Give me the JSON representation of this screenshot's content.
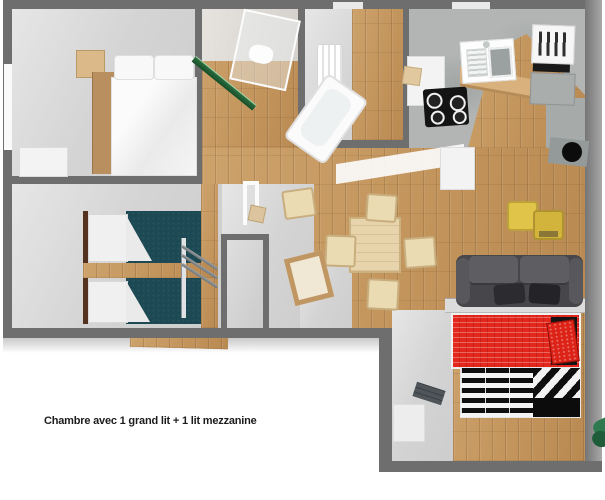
{
  "canvas": {
    "width": 605,
    "height": 500,
    "background": "#ffffff"
  },
  "caption": {
    "text": "Chambre avec 1 grand lit + 1 lit mezzanine"
  },
  "palette": {
    "wall": "#6e6e6e",
    "floor_wood": "#c69c64",
    "floor_gray": "#d4d4d4",
    "floor_concrete": "#b2b5b4",
    "bed_teal": "#1c4953",
    "bed_red": "#e3271d",
    "sofa_gray": "#47474b",
    "pouf_yellow": "#dfc449",
    "pouf_yellow2": "#d2b33c",
    "chair_beige": "#ebdbb2",
    "table_wood": "#e8d4ac",
    "ski_green": "#2c6e3f",
    "logo_green": "#2e7a4e",
    "logo_green2": "#1f5c39",
    "caption": "#1c1c1c"
  },
  "floorplan": {
    "type": "3d-floorplan-render",
    "rooms": [
      {
        "name": "bedroom-double",
        "furniture": [
          "double-bed-white",
          "nightstand",
          "dresser",
          "window"
        ]
      },
      {
        "name": "shower-room",
        "furniture": [
          "shower-cabin",
          "skis"
        ]
      },
      {
        "name": "bathroom",
        "furniture": [
          "bathtub",
          "radiator"
        ]
      },
      {
        "name": "kitchen",
        "furniture": [
          "sink",
          "cooktop",
          "oven-microwave-column",
          "wood-counter",
          "kitchen-cart",
          "pellet-stove"
        ]
      },
      {
        "name": "living-dining",
        "furniture": [
          "dining-table",
          "chair",
          "chair",
          "chair",
          "chair",
          "chair",
          "floor-cushion",
          "floor-cushion",
          "sofa",
          "cabinet",
          "framed-panel",
          "door-frame"
        ]
      },
      {
        "name": "bedroom-twin-teal",
        "furniture": [
          "twin-bed",
          "twin-bed",
          "mezzanine-ladder",
          "mezzanine-post"
        ]
      },
      {
        "name": "closet-wc",
        "furniture": []
      },
      {
        "name": "bedroom-mezzanine",
        "furniture": [
          "single-bed-red",
          "mezzanine-bed-striped",
          "bench",
          "rug"
        ]
      }
    ]
  },
  "logo": {
    "name": "green-leaf-logo"
  }
}
